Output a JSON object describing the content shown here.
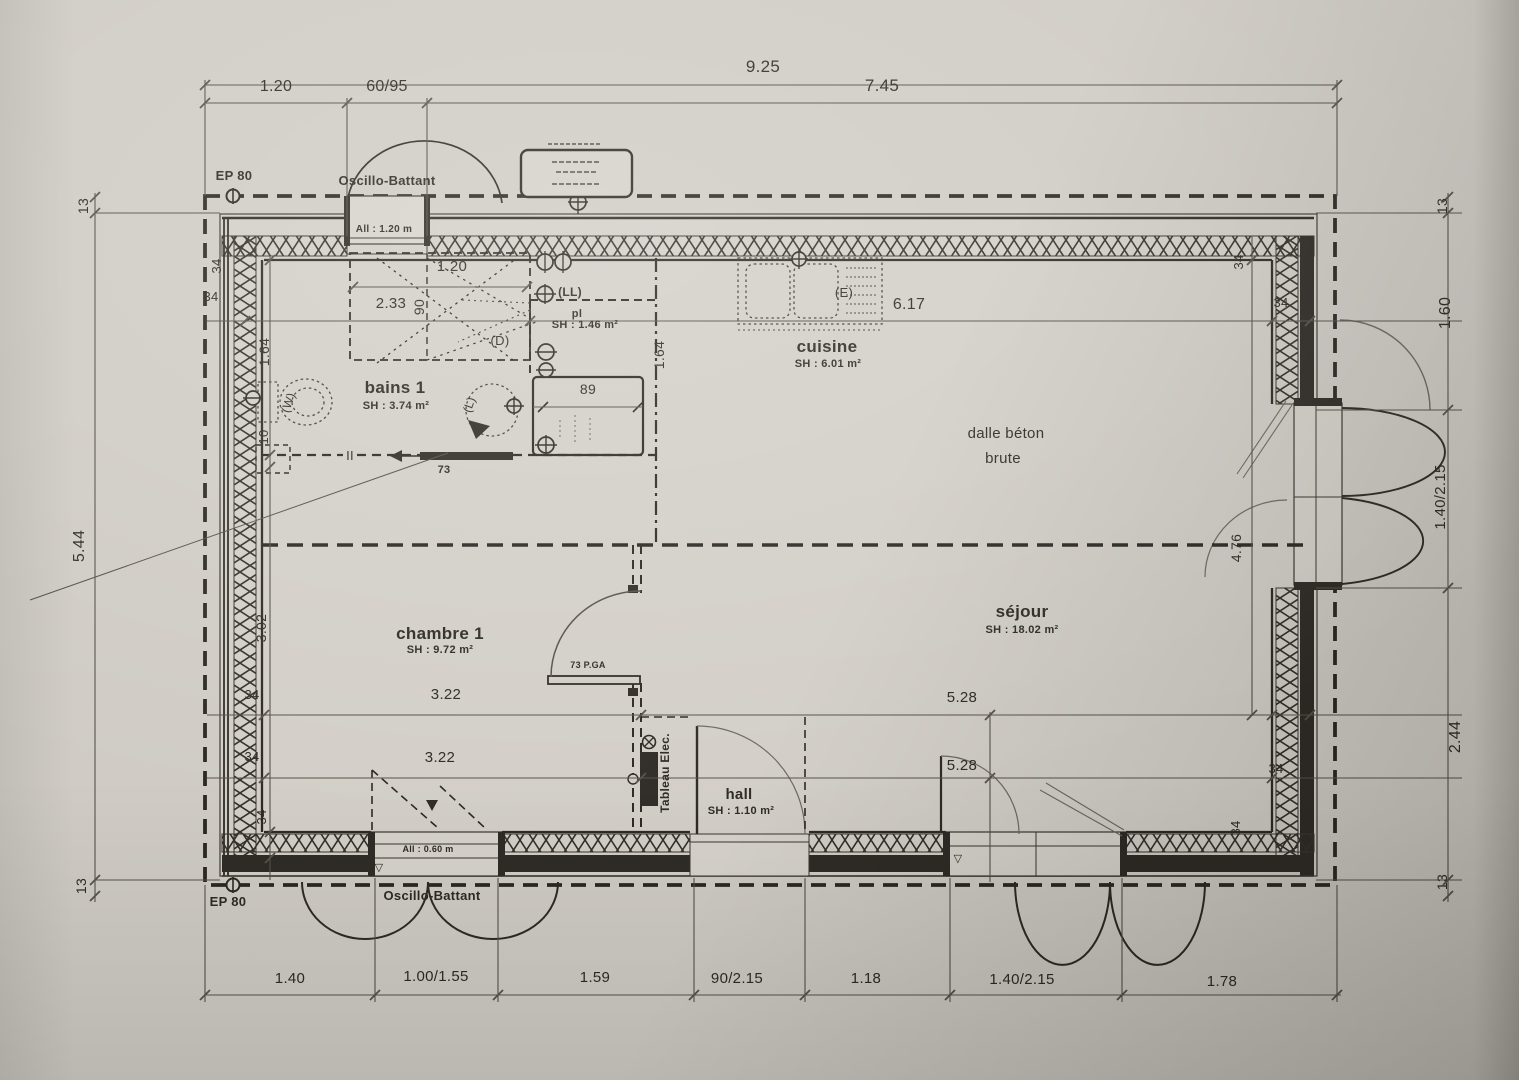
{
  "colors": {
    "paper": "#d2cec7",
    "ink": "#2e2a24",
    "thin": "#57524a",
    "gray_leaf": "#6e695f"
  },
  "rooms": [
    {
      "name": "bains 1",
      "surface": "SH : 3.74 m²"
    },
    {
      "name": "pl",
      "surface": "SH : 1.46 m²"
    },
    {
      "name": "cuisine",
      "surface": "SH : 6.01 m²"
    },
    {
      "name": "séjour",
      "surface": "SH : 18.02 m²"
    },
    {
      "name": "chambre 1",
      "surface": "SH : 9.72 m²"
    },
    {
      "name": "hall",
      "surface": "SH : 1.10 m²"
    }
  ],
  "labels": [
    {
      "id": "dim-overall-top",
      "t": "9.25",
      "x": 763,
      "y": 72,
      "s": 17
    },
    {
      "id": "dim-top-1",
      "t": "1.20",
      "x": 276,
      "y": 91,
      "s": 16
    },
    {
      "id": "dim-top-2",
      "t": "60/95",
      "x": 387,
      "y": 91,
      "s": 16
    },
    {
      "id": "dim-top-3",
      "t": "7.45",
      "x": 882,
      "y": 91,
      "s": 17
    },
    {
      "id": "ep80-top",
      "t": "EP 80",
      "x": 234,
      "y": 180,
      "s": 13,
      "w": 1
    },
    {
      "id": "oscillo-top",
      "t": "Oscillo-Battant",
      "x": 387,
      "y": 185,
      "s": 13,
      "w": 1
    },
    {
      "id": "allege-top",
      "t": "All : 1.20 m",
      "x": 384,
      "y": 232,
      "s": 10,
      "w": 1
    },
    {
      "id": "dim-13-left-top",
      "t": "13",
      "x": 88,
      "y": 206,
      "s": 14,
      "r": -90
    },
    {
      "id": "dim-left-overall",
      "t": "5.44",
      "x": 84,
      "y": 546,
      "s": 16,
      "r": -90
    },
    {
      "id": "dim-13-left-bottom",
      "t": "13",
      "x": 86,
      "y": 886,
      "s": 14,
      "r": -90
    },
    {
      "id": "dim-13-right-top",
      "t": "13",
      "x": 1447,
      "y": 206,
      "s": 14,
      "r": -90
    },
    {
      "id": "dim-right-1",
      "t": "1.60",
      "x": 1450,
      "y": 313,
      "s": 16,
      "r": -90
    },
    {
      "id": "dim-right-2",
      "t": "1.40/2.15",
      "x": 1445,
      "y": 497,
      "s": 15,
      "r": -90
    },
    {
      "id": "dim-right-3",
      "t": "2.44",
      "x": 1460,
      "y": 737,
      "s": 16,
      "r": -90
    },
    {
      "id": "dim-13-right-bottom",
      "t": "13",
      "x": 1447,
      "y": 882,
      "s": 14,
      "r": -90
    },
    {
      "id": "dim-34-left-wall-top",
      "t": "34",
      "x": 221,
      "y": 266,
      "s": 13,
      "r": -90
    },
    {
      "id": "dim-34-left-line1",
      "t": "34",
      "x": 211,
      "y": 301,
      "s": 13
    },
    {
      "id": "dim-bains-height",
      "t": "1.64",
      "x": 269,
      "y": 352,
      "s": 14,
      "r": -90
    },
    {
      "id": "dim-cloison-10",
      "t": "10",
      "x": 268,
      "y": 437,
      "s": 13,
      "r": -90
    },
    {
      "id": "dim-chambre-height",
      "t": "3.02",
      "x": 266,
      "y": 628,
      "s": 14,
      "r": -90
    },
    {
      "id": "dim-34-left-line2",
      "t": "34",
      "x": 252,
      "y": 699,
      "s": 13
    },
    {
      "id": "dim-34-left-line3",
      "t": "34",
      "x": 252,
      "y": 761,
      "s": 13
    },
    {
      "id": "dim-34-left-wall-bottom",
      "t": "34",
      "x": 266,
      "y": 817,
      "s": 13,
      "r": -90
    },
    {
      "id": "dim-tremie-120",
      "t": "1.20",
      "x": 452,
      "y": 271,
      "s": 15
    },
    {
      "id": "dim-233",
      "t": "2.33",
      "x": 391,
      "y": 308,
      "s": 15
    },
    {
      "id": "dim-tremie-90",
      "t": "90",
      "x": 424,
      "y": 307,
      "s": 14,
      "r": -90
    },
    {
      "id": "dim-617",
      "t": "6.17",
      "x": 909,
      "y": 309,
      "s": 16
    },
    {
      "id": "dim-34-right-wall-top",
      "t": "34",
      "x": 1243,
      "y": 262,
      "s": 13,
      "r": -90
    },
    {
      "id": "dim-34-right-line1",
      "t": "34",
      "x": 1281,
      "y": 307,
      "s": 13
    },
    {
      "id": "fixture-ll",
      "t": "(LL)",
      "x": 570,
      "y": 296,
      "s": 12,
      "w": 1
    },
    {
      "id": "room-pl",
      "t": "pl",
      "x": 577,
      "y": 317,
      "s": 11,
      "w": 1
    },
    {
      "id": "room-pl-area",
      "t": "SH : 1.46 m²",
      "x": 585,
      "y": 328,
      "s": 11,
      "w": 1
    },
    {
      "id": "fixture-d",
      "t": "(D)",
      "x": 500,
      "y": 345,
      "s": 13
    },
    {
      "id": "dim-164-mid",
      "t": "1.64",
      "x": 664,
      "y": 355,
      "s": 14,
      "r": -90
    },
    {
      "id": "room-cuisine",
      "t": "cuisine",
      "x": 827,
      "y": 352,
      "s": 17,
      "w": 1
    },
    {
      "id": "room-cuisine-area",
      "t": "SH : 6.01 m²",
      "x": 828,
      "y": 367,
      "s": 11,
      "w": 1
    },
    {
      "id": "fixture-e",
      "t": "(E)",
      "x": 844,
      "y": 297,
      "s": 13
    },
    {
      "id": "room-bains",
      "t": "bains 1",
      "x": 395,
      "y": 393,
      "s": 17,
      "w": 1
    },
    {
      "id": "room-bains-area",
      "t": "SH : 3.74 m²",
      "x": 396,
      "y": 409,
      "s": 11,
      "w": 1
    },
    {
      "id": "fixture-w",
      "t": "(W)",
      "x": 292,
      "y": 404,
      "s": 12,
      "r": -70
    },
    {
      "id": "fixture-l",
      "t": "(L)",
      "x": 473,
      "y": 406,
      "s": 12,
      "r": -70
    },
    {
      "id": "dim-placard-89",
      "t": "89",
      "x": 588,
      "y": 394,
      "s": 14
    },
    {
      "id": "note-dalle-1",
      "t": "dalle béton",
      "x": 1006,
      "y": 438,
      "s": 15
    },
    {
      "id": "note-dalle-2",
      "t": "brute",
      "x": 1003,
      "y": 463,
      "s": 15
    },
    {
      "id": "dim-porte-73",
      "t": "73",
      "x": 444,
      "y": 473,
      "s": 11,
      "w": 1
    },
    {
      "id": "dim-476",
      "t": "4.76",
      "x": 1241,
      "y": 548,
      "s": 14,
      "r": -90
    },
    {
      "id": "room-sejour",
      "t": "séjour",
      "x": 1022,
      "y": 617,
      "s": 17,
      "w": 1
    },
    {
      "id": "room-sejour-area",
      "t": "SH : 18.02 m²",
      "x": 1022,
      "y": 633,
      "s": 11,
      "w": 1
    },
    {
      "id": "room-chambre",
      "t": "chambre 1",
      "x": 440,
      "y": 639,
      "s": 17,
      "w": 1
    },
    {
      "id": "room-chambre-area",
      "t": "SH : 9.72 m²",
      "x": 440,
      "y": 653,
      "s": 11,
      "w": 1
    },
    {
      "id": "door-73pga",
      "t": "73 P.GA",
      "x": 588,
      "y": 668,
      "s": 9,
      "w": 1
    },
    {
      "id": "dim-322-a",
      "t": "3.22",
      "x": 446,
      "y": 699,
      "s": 15
    },
    {
      "id": "dim-528-a",
      "t": "5.28",
      "x": 962,
      "y": 702,
      "s": 15
    },
    {
      "id": "dim-322-b",
      "t": "3.22",
      "x": 440,
      "y": 762,
      "s": 15
    },
    {
      "id": "dim-528-b",
      "t": "5.28",
      "x": 962,
      "y": 770,
      "s": 15
    },
    {
      "id": "tableau-elec",
      "t": "Tableau Elec.",
      "x": 669,
      "y": 773,
      "s": 12,
      "w": 1,
      "r": -90
    },
    {
      "id": "room-hall",
      "t": "hall",
      "x": 739,
      "y": 799,
      "s": 15,
      "w": 1
    },
    {
      "id": "room-hall-area",
      "t": "SH : 1.10 m²",
      "x": 741,
      "y": 814,
      "s": 11,
      "w": 1
    },
    {
      "id": "dim-34-right-line2",
      "t": "34",
      "x": 1276,
      "y": 773,
      "s": 13
    },
    {
      "id": "dim-34-right-wall-bottom",
      "t": "34",
      "x": 1240,
      "y": 828,
      "s": 13,
      "r": -90
    },
    {
      "id": "allege-bottom",
      "t": "All : 0.60 m",
      "x": 428,
      "y": 852,
      "s": 9,
      "w": 1
    },
    {
      "id": "tri-mark-1",
      "t": "▽",
      "x": 379,
      "y": 871,
      "s": 11
    },
    {
      "id": "tri-mark-2",
      "t": "▽",
      "x": 958,
      "y": 862,
      "s": 11
    },
    {
      "id": "sym-ii",
      "t": "II",
      "x": 350,
      "y": 460,
      "s": 13
    },
    {
      "id": "ep80-bottom",
      "t": "EP 80",
      "x": 228,
      "y": 906,
      "s": 13,
      "w": 1
    },
    {
      "id": "oscillo-bottom",
      "t": "Oscillo-Battant",
      "x": 432,
      "y": 900,
      "s": 13,
      "w": 1
    },
    {
      "id": "dim-bot-1",
      "t": "1.40",
      "x": 290,
      "y": 983,
      "s": 15
    },
    {
      "id": "dim-bot-2",
      "t": "1.00/1.55",
      "x": 436,
      "y": 981,
      "s": 15
    },
    {
      "id": "dim-bot-3",
      "t": "1.59",
      "x": 595,
      "y": 982,
      "s": 15
    },
    {
      "id": "dim-bot-4",
      "t": "90/2.15",
      "x": 737,
      "y": 983,
      "s": 15
    },
    {
      "id": "dim-bot-5",
      "t": "1.18",
      "x": 866,
      "y": 983,
      "s": 15
    },
    {
      "id": "dim-bot-6",
      "t": "1.40/2.15",
      "x": 1022,
      "y": 984,
      "s": 15
    },
    {
      "id": "dim-bot-7",
      "t": "1.78",
      "x": 1222,
      "y": 986,
      "s": 15
    }
  ]
}
